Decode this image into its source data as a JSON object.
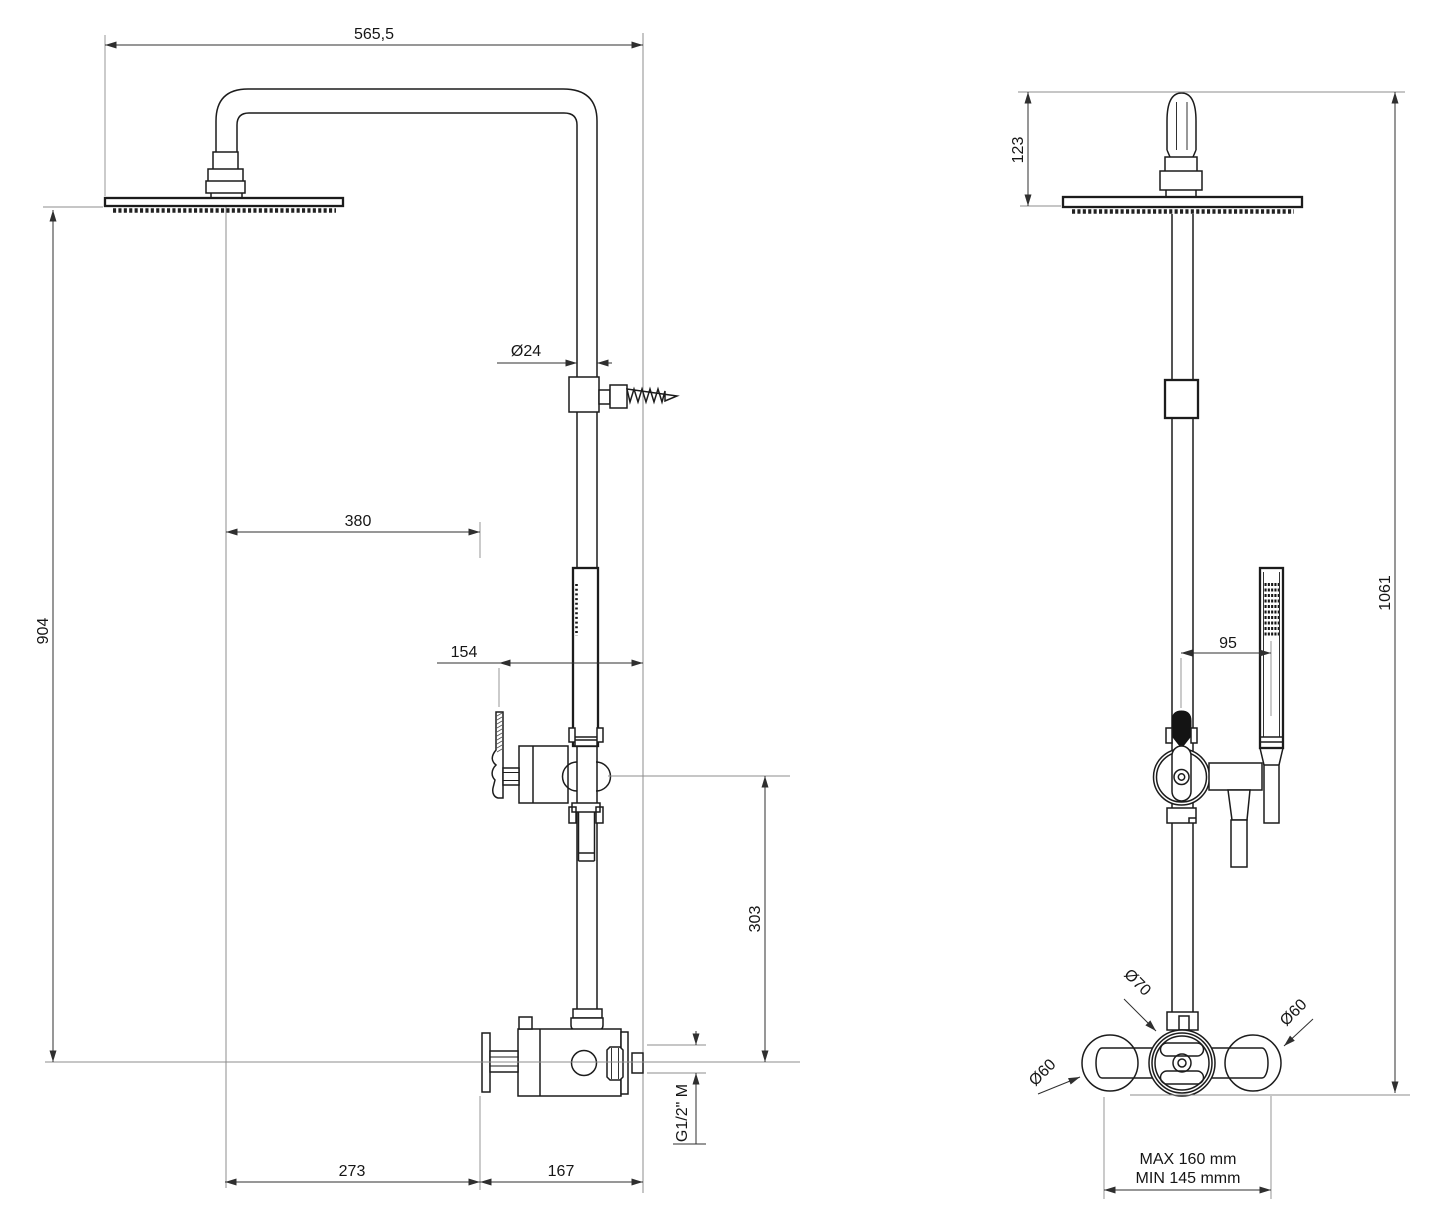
{
  "dimensions": {
    "overall_depth": "565,5",
    "pipe_diameter": "Ø24",
    "head_to_wall": "380",
    "head_height": "904",
    "holder_depth": "154",
    "holder_height": "303",
    "depth_lower": "273",
    "depth_outlet": "167",
    "outlet_thread": "G1/2\" M",
    "arm_rise": "123",
    "total_height": "1061",
    "handshower_offset": "95",
    "knob_diameter": "Ø70",
    "connector_left_diameter": "Ø60",
    "connector_right_diameter": "Ø60",
    "connection_spacing_max": "MAX 160 mm",
    "connection_spacing_min": "MIN 145 mmm"
  }
}
